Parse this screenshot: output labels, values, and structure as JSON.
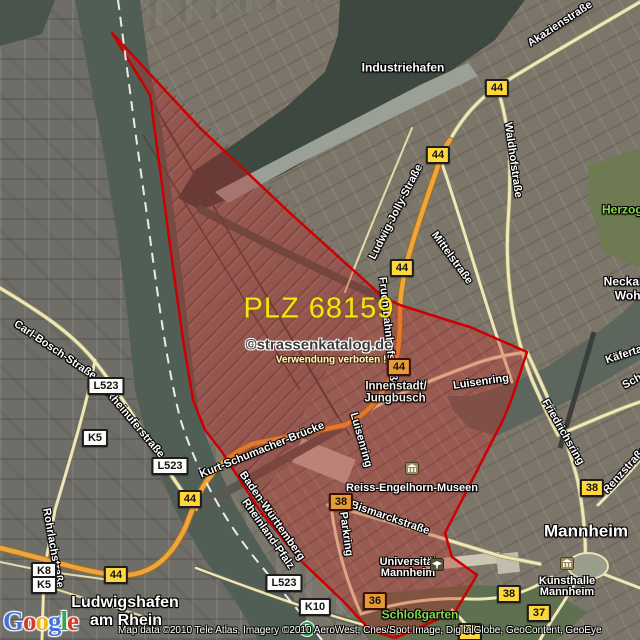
{
  "map": {
    "plz_title": "PLZ 68159",
    "watermark_line1": "©strassenkatalog.de",
    "watermark_line2": "Verwendung verboten !",
    "attribution": "Map data ©2010 Tele Atlas, Imagery ©2010 AeroWest, Cnes/Spot Image, DigitalGlobe, GeoContent, GeoEye"
  },
  "logo": {
    "l1": "G",
    "l2": "o",
    "l3": "o",
    "l4": "g",
    "l5": "l",
    "l6": "e"
  },
  "badges": {
    "b44": "44",
    "b38": "38",
    "b37": "37",
    "b36": "36",
    "l523": "L523",
    "k5": "K5",
    "k8": "K8",
    "k10": "K10"
  },
  "transit": {
    "sbahn": "S"
  },
  "roads": {
    "akazienstrasse": "Akazienstraße",
    "waldhofstrasse": "Waldhofstraße",
    "ludwig_jolly_strasse": "Ludwig-Jolly-Straße",
    "mittelstrasse": "Mittelstraße",
    "kaefertaler_strasse": "Käfertaler Straße",
    "schafweide": "Schafweide",
    "friedrichsring": "Friedrichsring",
    "renzstrasse": "Renzstraße",
    "luisenring": "Luisenring",
    "fruchtbahnhofstrasse": "Fruchtbahnhofstraße",
    "bismarckstrasse": "Bismarckstraße",
    "parkring": "Parkring",
    "kurt_schumacher_bruecke": "Kurt-Schumacher-Brücke",
    "carl_bosch_strasse": "Carl-Bosch-Straße",
    "rheinuferstrasse": "Rheinuferstraße",
    "rohrlachstrasse": "Rohrlachstraße"
  },
  "borders": {
    "baden_wuerttemberg": "Baden-Württemberg",
    "rheinland_pfalz": "Rheinland-Pfalz"
  },
  "places": {
    "industriehafen": "Industriehafen",
    "herzogenriedpark": "Herzogenriedpark",
    "neckarstadt": "Neckarstadt",
    "wohlgelegen": "Wohlgelegen",
    "innenstadt": "Innenstadt/",
    "jungbusch": "Jungbusch",
    "mannheim": "Mannheim",
    "ludwigshafen": "Ludwigshafen",
    "am_rhein": "am Rhein",
    "universitaet": "Universität",
    "universitaet2": "Mannheim",
    "rem": "Reiss-Engelhorn-Museen",
    "kunsthalle": "Kunsthalle",
    "kunsthalle2": "Mannheim",
    "schlossgarten": "Schloßgarten"
  },
  "colors": {
    "overlay_stroke": "#cc0000",
    "overlay_fill": "rgba(193,34,34,0.34)",
    "plz_text": "#f2e60a",
    "badge_yellow": "#fed73c",
    "badge_tinted": "#e59b35",
    "road_orange": "#f0a43c",
    "road_yellow": "#efe8b6",
    "water": "#53605a",
    "logo_blue": "#4273db",
    "logo_red": "#d43b2a",
    "logo_yellow": "#f7b611",
    "logo_green": "#35a853"
  }
}
